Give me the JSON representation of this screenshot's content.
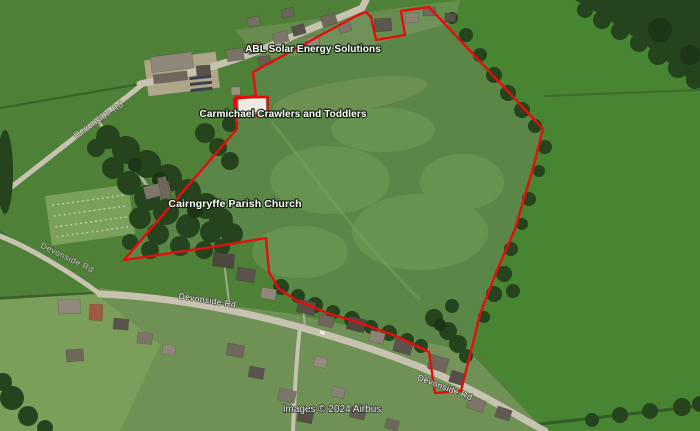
{
  "map": {
    "attribution": "Images © 2024 Airbus"
  },
  "labels": {
    "business_solar": "ABL Solar Energy Solutions",
    "playgroup": "Carmichael Crawlers and Toddlers",
    "church": "Cairngryffe Parish Church",
    "road": "Devonside Rd"
  },
  "boundary": {
    "color": "#e60d0d",
    "main_points": "253,72 356,16 366,12 371,17 376,40 405,35 401,11 429,7 543,129 533,168 515,229 496,273 480,314 473,343 461,391 435,393 429,352 396,336 357,322 327,313 296,300 279,289 269,272 266,238 212,247 124,260 237,129 234,99 256,96 253,72",
    "excluded_plot_points": "236,97 268,97 268,116 236,116 236,97"
  },
  "colors": {
    "field_green": "#4e8038",
    "bright_field_green": "#478533",
    "enclosed_field_green": "#5a8747",
    "tree_green": "#25431d",
    "road_gray": "#c8c2b0",
    "label_text": "#ffffff",
    "boundary_red": "#e60d0d"
  }
}
